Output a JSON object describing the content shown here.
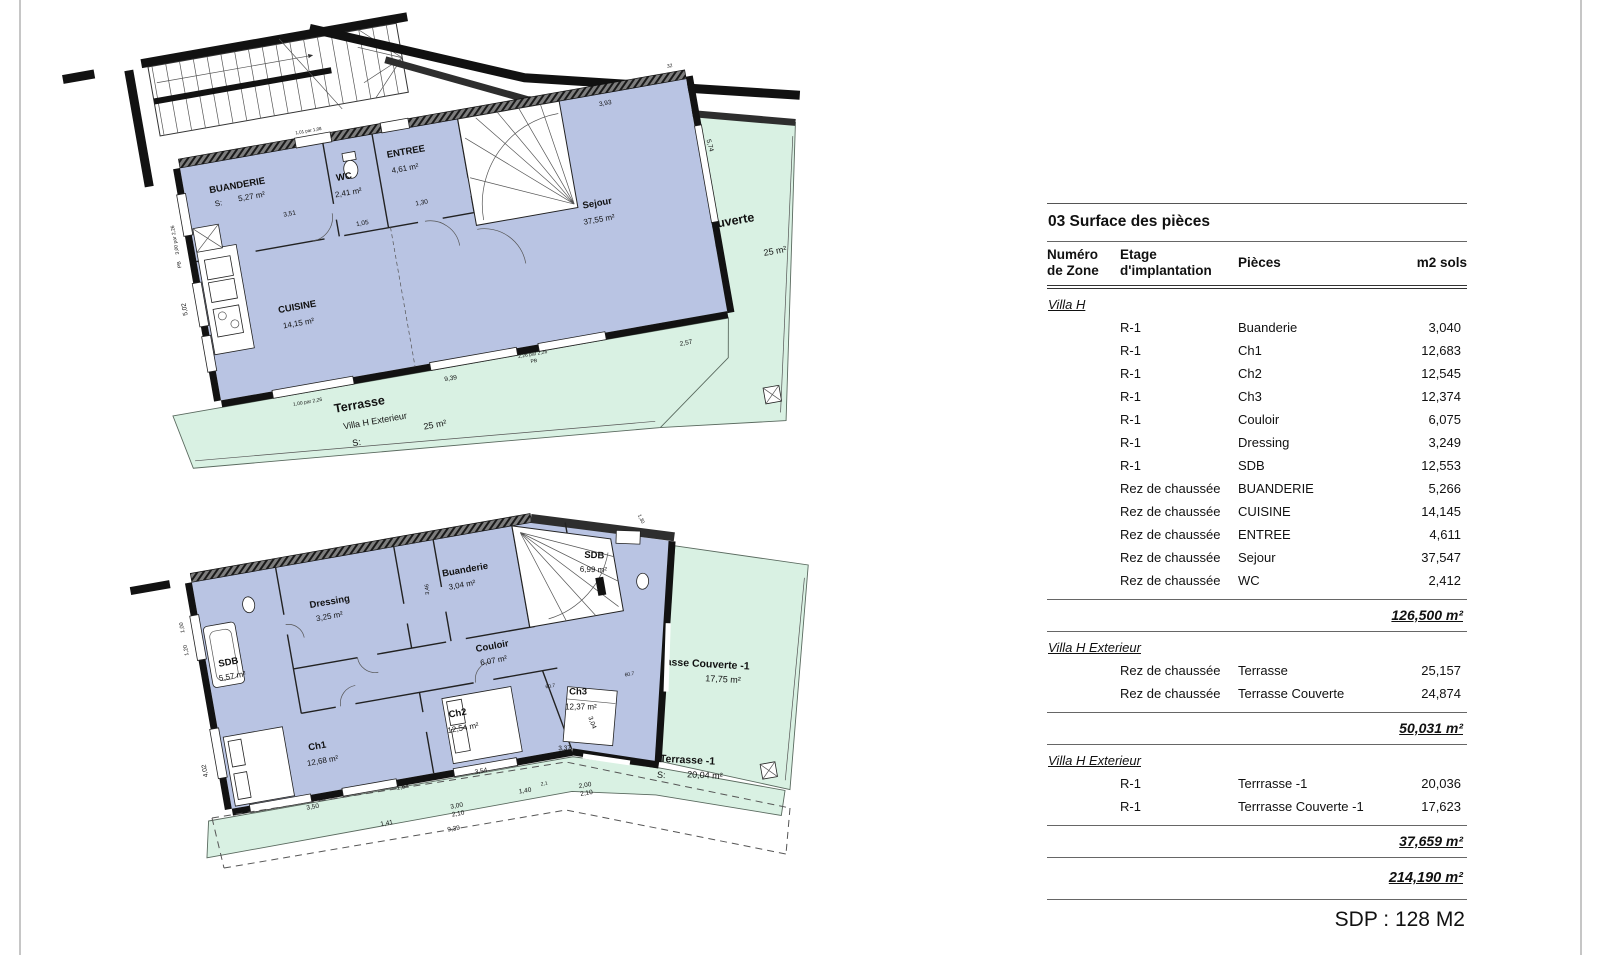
{
  "table": {
    "title": "03 Surface des pièces",
    "headers": {
      "col1a": "Numéro",
      "col1b": "de Zone",
      "col2a": "Etage",
      "col2b": "d'implantation",
      "col3": "Pièces",
      "col4": "m2 sols"
    },
    "sections": [
      {
        "group": "Villa H",
        "rows": [
          [
            "R-1",
            "Buanderie",
            "3,040"
          ],
          [
            "R-1",
            "Ch1",
            "12,683"
          ],
          [
            "R-1",
            "Ch2",
            "12,545"
          ],
          [
            "R-1",
            "Ch3",
            "12,374"
          ],
          [
            "R-1",
            "Couloir",
            "6,075"
          ],
          [
            "R-1",
            "Dressing",
            "3,249"
          ],
          [
            "R-1",
            "SDB",
            "12,553"
          ],
          [
            "Rez de chaussée",
            "BUANDERIE",
            "5,266"
          ],
          [
            "Rez de chaussée",
            "CUISINE",
            "14,145"
          ],
          [
            "Rez de chaussée",
            "ENTREE",
            "4,611"
          ],
          [
            "Rez de chaussée",
            "Sejour",
            "37,547"
          ],
          [
            "Rez de chaussée",
            "WC",
            "2,412"
          ]
        ],
        "subtotal": "126,500 m²"
      },
      {
        "group": "Villa H Exterieur",
        "rows": [
          [
            "Rez de chaussée",
            "Terrasse",
            "25,157"
          ],
          [
            "Rez de chaussée",
            "Terrasse Couverte",
            "24,874"
          ]
        ],
        "subtotal": "50,031 m²"
      },
      {
        "group": "Villa H Exterieur",
        "rows": [
          [
            "R-1",
            "Terrrasse -1",
            "20,036"
          ],
          [
            "R-1",
            "Terrrasse Couverte -1",
            "17,623"
          ]
        ],
        "subtotal": "37,659 m²"
      }
    ],
    "total": "214,190 m²",
    "sdp": "SDP : 128 M2"
  },
  "plans": {
    "s_label": "S:",
    "upper": {
      "rooms": [
        {
          "name": "BUANDERIE",
          "area": "5,27 m²"
        },
        {
          "name": "WC",
          "area": "2,41 m²"
        },
        {
          "name": "ENTREE",
          "area": "4,61 m²"
        },
        {
          "name": "Sejour",
          "area": "37,55 m²"
        },
        {
          "name": "CUISINE",
          "area": "14,15 m²"
        }
      ],
      "terraces": [
        {
          "name": "Terrasse",
          "sub": "Villa H Exterieur",
          "area": "25 m²"
        },
        {
          "name": "Terrasse Couverte",
          "sub": "Villa H Exterieur",
          "area": "25 m²"
        }
      ],
      "dims": [
        {
          "t": "3,51",
          "x": 100,
          "y": 66
        },
        {
          "t": "1,05",
          "x": 170,
          "y": 88
        },
        {
          "t": "1,30",
          "x": 232,
          "y": 78
        },
        {
          "t": "3,93",
          "x": 430,
          "y": 12
        },
        {
          "t": "5,74",
          "x": 524,
          "y": 70,
          "a": 85
        },
        {
          "t": "2,57",
          "x": 468,
          "y": 262
        },
        {
          "t": "9,39",
          "x": 230,
          "y": 256
        },
        {
          "t": "2,26 par 2,26",
          "x": 315,
          "y": 246,
          "s": 5
        },
        {
          "t": "PB",
          "x": 315,
          "y": 253,
          "s": 5
        },
        {
          "t": "1,88 par 2,26",
          "x": 455,
          "y": 241,
          "s": 5
        },
        {
          "t": "1,01 par 1,08",
          "x": 133,
          "y": -13,
          "s": 4.5
        },
        {
          "t": "3,00 par 2,26",
          "x": -16,
          "y": 70,
          "a": -90,
          "s": 5
        },
        {
          "t": "PB",
          "x": -16,
          "y": 95,
          "a": -90,
          "s": 5
        },
        {
          "t": "5,02",
          "x": -18,
          "y": 140,
          "a": -90
        },
        {
          "t": "32",
          "x": 500,
          "y": -14,
          "s": 5
        },
        {
          "t": "1,00 par 2,26",
          "x": 85,
          "y": 254,
          "s": 5
        }
      ]
    },
    "lower": {
      "rooms": [
        {
          "name": "SDB",
          "area": "5,57 m²"
        },
        {
          "name": "Dressing",
          "area": "3,25 m²"
        },
        {
          "name": "Buanderie",
          "area": "3,04 m²"
        },
        {
          "name": "Couloir",
          "area": "6,07 m²"
        },
        {
          "name": "Ch1",
          "area": "12,68 m²"
        },
        {
          "name": "Ch2",
          "area": "12,54 m²"
        },
        {
          "name": "Ch3",
          "area": "12,37 m²"
        },
        {
          "name": "SDB",
          "area": "6,99 m²"
        }
      ],
      "terraces": [
        {
          "name": "Terrasse Couverte -1",
          "area": "17,75 m²"
        },
        {
          "name": "Terrasse -1",
          "area": "20,04 m²"
        }
      ],
      "dims": [
        {
          "t": "3,50",
          "x": 80,
          "y": 226
        },
        {
          "t": "1,64",
          "x": 172,
          "y": 222
        },
        {
          "t": "3,54",
          "x": 252,
          "y": 220
        },
        {
          "t": "3,37",
          "x": 338,
          "y": 212,
          "a": 8
        },
        {
          "t": "3,04",
          "x": 368,
          "y": 190,
          "a": 80
        },
        {
          "t": "2,19",
          "x": 400,
          "y": 55,
          "a": 80
        },
        {
          "t": "1,41",
          "x": 150,
          "y": 255
        },
        {
          "t": "3,00",
          "x": 222,
          "y": 250
        },
        {
          "t": "2,10",
          "x": 222,
          "y": 258
        },
        {
          "t": "1,40",
          "x": 292,
          "y": 247
        },
        {
          "t": "2,1",
          "x": 312,
          "y": 243,
          "s": 5
        },
        {
          "t": "2,00",
          "x": 352,
          "y": 252
        },
        {
          "t": "2,10",
          "x": 352,
          "y": 260
        },
        {
          "t": "9,39",
          "x": 215,
          "y": 272
        },
        {
          "t": "4,02",
          "x": -18,
          "y": 170,
          "a": -90
        },
        {
          "t": "1,00",
          "x": -16,
          "y": 25,
          "a": -90,
          "s": 5.5
        },
        {
          "t": "1,20",
          "x": -16,
          "y": 48,
          "a": -90,
          "s": 5.5
        },
        {
          "t": "3,46",
          "x": 232,
          "y": 30,
          "a": -85,
          "s": 5.5
        },
        {
          "t": "60.7",
          "x": 335,
          "y": 148,
          "s": 5
        },
        {
          "t": "60.7",
          "x": 415,
          "y": 150,
          "s": 5
        },
        {
          "t": "1,30",
          "x": 452,
          "y": -2,
          "a": 75,
          "s": 5
        }
      ]
    }
  }
}
